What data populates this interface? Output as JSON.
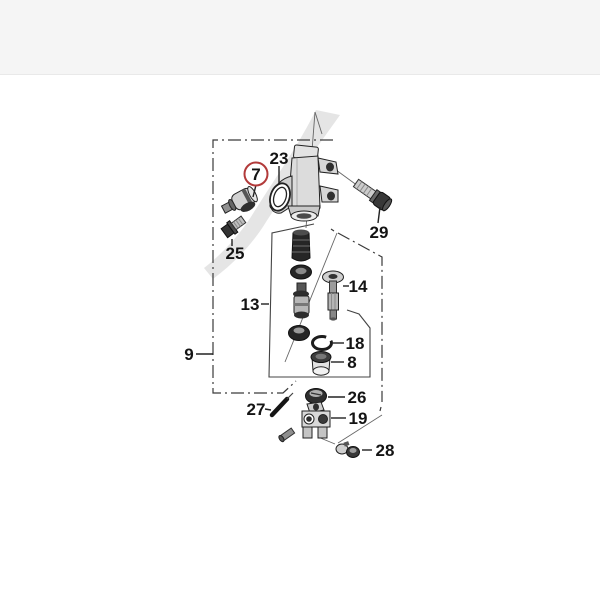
{
  "diagram": {
    "type": "exploded-parts-diagram",
    "highlight_color": "#b23a3a",
    "line_color": "#3a3a3a",
    "callouts": [
      {
        "id": "7",
        "highlighted": true
      },
      {
        "id": "23",
        "highlighted": false
      },
      {
        "id": "25",
        "highlighted": false
      },
      {
        "id": "29",
        "highlighted": false
      },
      {
        "id": "13",
        "highlighted": false
      },
      {
        "id": "14",
        "highlighted": false
      },
      {
        "id": "18",
        "highlighted": false
      },
      {
        "id": "8",
        "highlighted": false
      },
      {
        "id": "9",
        "highlighted": false
      },
      {
        "id": "26",
        "highlighted": false
      },
      {
        "id": "19",
        "highlighted": false
      },
      {
        "id": "27",
        "highlighted": false
      },
      {
        "id": "28",
        "highlighted": false
      }
    ],
    "parts": [
      "master-cylinder-body",
      "oil-joint-fitting-7",
      "washer-23",
      "flange-bolt-25",
      "socket-bolt-29",
      "piston-kit-13",
      "push-rod-14",
      "snap-ring-18",
      "boot-cup-8",
      "grommet-26",
      "rod-joint-clevis-19",
      "spring-pin-27",
      "pipe-clamp-28"
    ]
  }
}
